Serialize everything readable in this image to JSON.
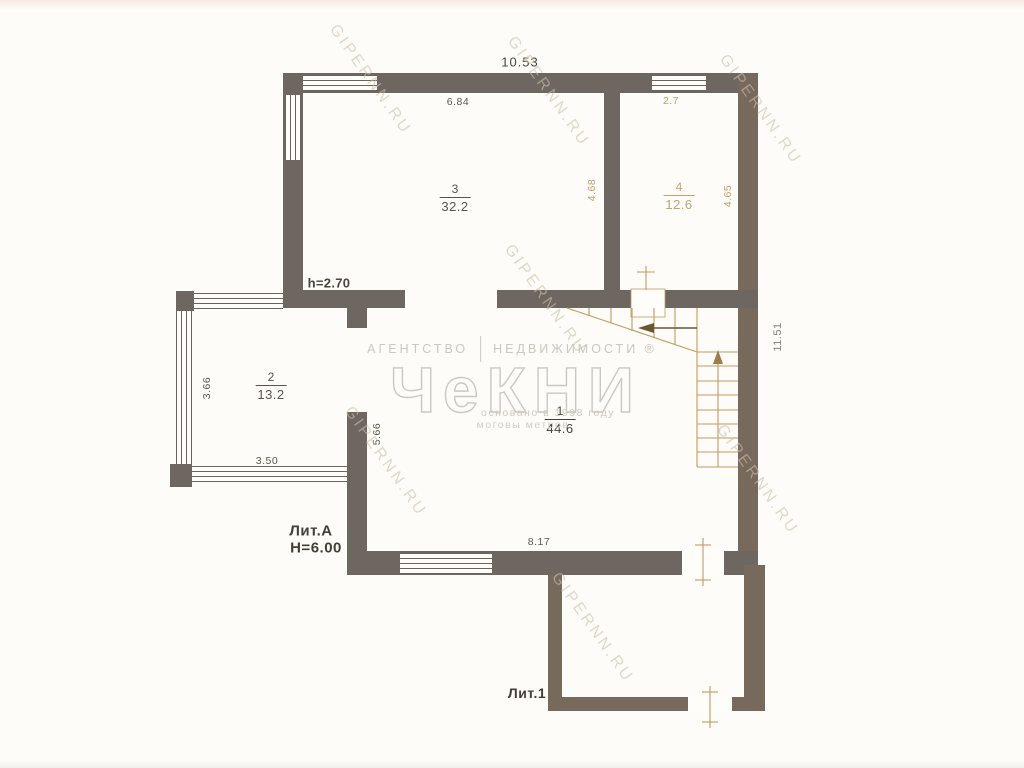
{
  "plan": {
    "dims": {
      "top_width": "10.53",
      "room3_top": "6.84",
      "room4_top": "2.7",
      "room4_left": "4.68",
      "room4_right": "4.65",
      "right_side": "11.51",
      "room2_left": "3.66",
      "room2_bottom": "3.50",
      "room1_left_wall": "5.66",
      "room1_bottom": "8.17",
      "ceiling_height": "h=2.70"
    },
    "labels": {
      "building": "Лит.А",
      "building_height": "H=6.00",
      "annex": "Лит.1"
    },
    "rooms": {
      "r1": {
        "number": "1",
        "area": "44.6"
      },
      "r2": {
        "number": "2",
        "area": "13.2"
      },
      "r3": {
        "number": "3",
        "area": "32.2"
      },
      "r4": {
        "number": "4",
        "area": "12.6"
      }
    }
  },
  "watermark": {
    "agency_word1": "АГЕНТСТВО",
    "agency_word2": "НЕДВИЖИМОСТИ ®",
    "logo": "ЧеКНИ",
    "founded": "основано в 1998 году",
    "slogan": "моговы метров",
    "site": "GIPERNN.RU"
  }
}
